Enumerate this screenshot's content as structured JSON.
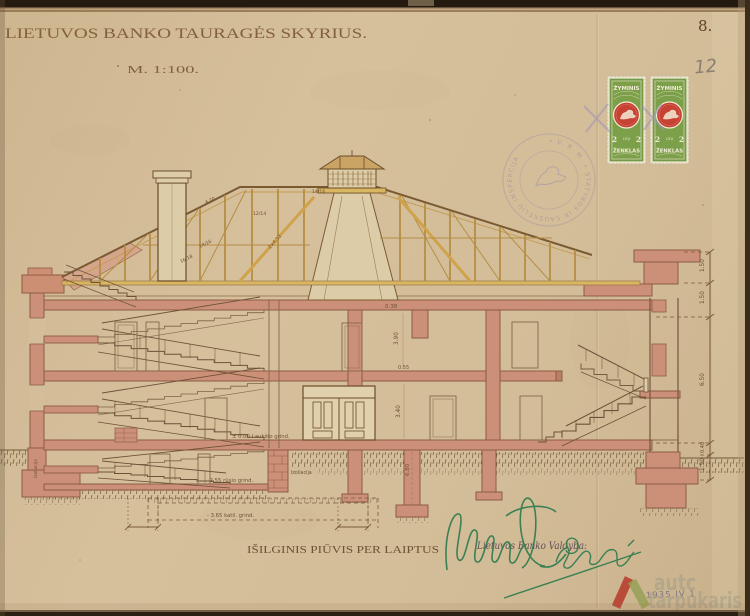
{
  "document": {
    "title": "LIETUVOS BANKO TAURAGĖS SKYRIUS.",
    "scale": "M. 1:100.",
    "sheet_number": "8.",
    "page_number_pencil": "12",
    "caption": "IŠILGINIS PIŪVIS PER LAIPTUS",
    "board_stamp": "Lietuvos Banko Valdyba:",
    "date_stamp": "1935 IV 1"
  },
  "revenue_stamp": {
    "header": "ŽYMINIS",
    "value": "2",
    "currency": "LITŲ",
    "footer": "ŽENKLAS"
  },
  "seal": {
    "ring_text": "• V. R. M. •  STATYBOS IR SAUSKELIŲ INSPEKCIJA"
  },
  "annotations": {
    "levels": [
      "± 0.00 I aukšto grind.",
      "- 2.55 rūsio grind.",
      "- 3.65 katil. grind."
    ],
    "insulation": "Izoliacija",
    "dims_right": [
      "1.50",
      "1.50",
      "6.50",
      "0.40",
      "1.50"
    ],
    "dims_interior": [
      "0.38",
      "3.90",
      "0.55",
      "3.40",
      "6.80"
    ],
    "truss_marks": [
      "4.20",
      "12/14",
      "14/16",
      "16/18",
      "2×4.30",
      "14/16"
    ]
  },
  "watermark": {
    "line1": "autc",
    "line2": "tarpukaris"
  },
  "colors": {
    "paper": "#d4be9a",
    "ink": "#7a5a36",
    "wall_fill": "#cc9078",
    "truss_yellow": "#c8a052",
    "stamp_green": "#7ca04a",
    "stamp_red": "#c84233",
    "signature_green": "#2f7c4e",
    "seal_purple": "#8d86a8"
  }
}
